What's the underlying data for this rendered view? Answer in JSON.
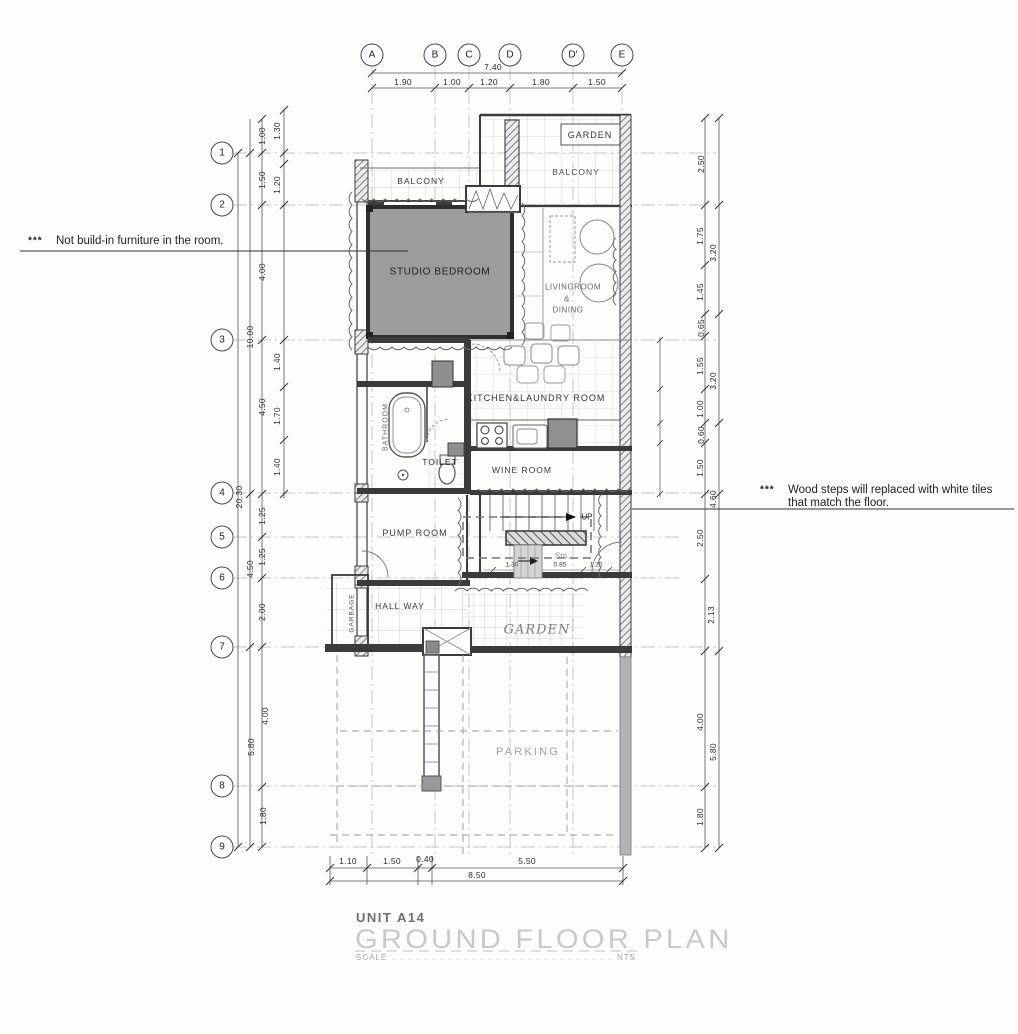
{
  "grid": {
    "cols": [
      "A",
      "B",
      "C",
      "D",
      "D'",
      "E"
    ],
    "rows": [
      "1",
      "2",
      "3",
      "4",
      "5",
      "6",
      "7",
      "8",
      "9"
    ]
  },
  "dims": {
    "top_total": "7.40",
    "top": [
      "1.90",
      "1.00",
      "1.20",
      "1.80",
      "1.50"
    ],
    "left": [
      "1.00",
      "1.30",
      "1.50",
      "1.20",
      "4.00",
      "10.00",
      "1.40",
      "4.50",
      "1.70",
      "1.40",
      "20.30",
      "1.25",
      "1.25",
      "4.50",
      "2.00",
      "4.00",
      "5.80",
      "1.80"
    ],
    "right": [
      "2.50",
      "1.75",
      "3.20",
      "1.45",
      "0.65",
      "1.55",
      "3.20",
      "1.00",
      "0.60",
      "1.50",
      "4.60",
      "2.50",
      "2.13",
      "4.00",
      "5.80",
      "1.80"
    ],
    "bottom": [
      "1.10",
      "1.50",
      "0.40",
      "5.50"
    ],
    "bottom_total": "8.50",
    "stair": [
      "1.30",
      "0.85",
      "1.25"
    ]
  },
  "rooms": {
    "garden_top": "GARDEN",
    "balcony_left": "BALCONY",
    "balcony_right": "BALCONY",
    "studio_bedroom": "STUDIO BEDROOM",
    "living_1": "LIVINGROOM",
    "living_2": "&",
    "living_3": "DINING",
    "kitchen": "KITCHEN&LAUNDRY ROOM",
    "bathroom": "BATHROOM",
    "toilet": "TOILET",
    "wine": "WINE ROOM",
    "pump": "PUMP ROOM",
    "sto": "Sto.",
    "up": "UP",
    "hall": "HALL WAY",
    "garbage": "GARBAGE",
    "garden_bottom": "GARDEN",
    "parking": "PARKING"
  },
  "notes": {
    "n1_marker": "***",
    "n1_text": "Not build-in furniture in the room.",
    "n2_marker": "***",
    "n2_line1": "Wood steps will replaced with white tiles",
    "n2_line2": "that match the floor."
  },
  "title_block": {
    "unit": "UNIT A14",
    "title": "GROUND FLOOR PLAN",
    "scale_label": "SCALE",
    "scale_value": "NTS"
  },
  "colors": {
    "wall": "#3b3b3b",
    "room_fill": "#9c9c9c",
    "tile_line": "#cccccc",
    "faded_title": "#c9c9c9"
  }
}
